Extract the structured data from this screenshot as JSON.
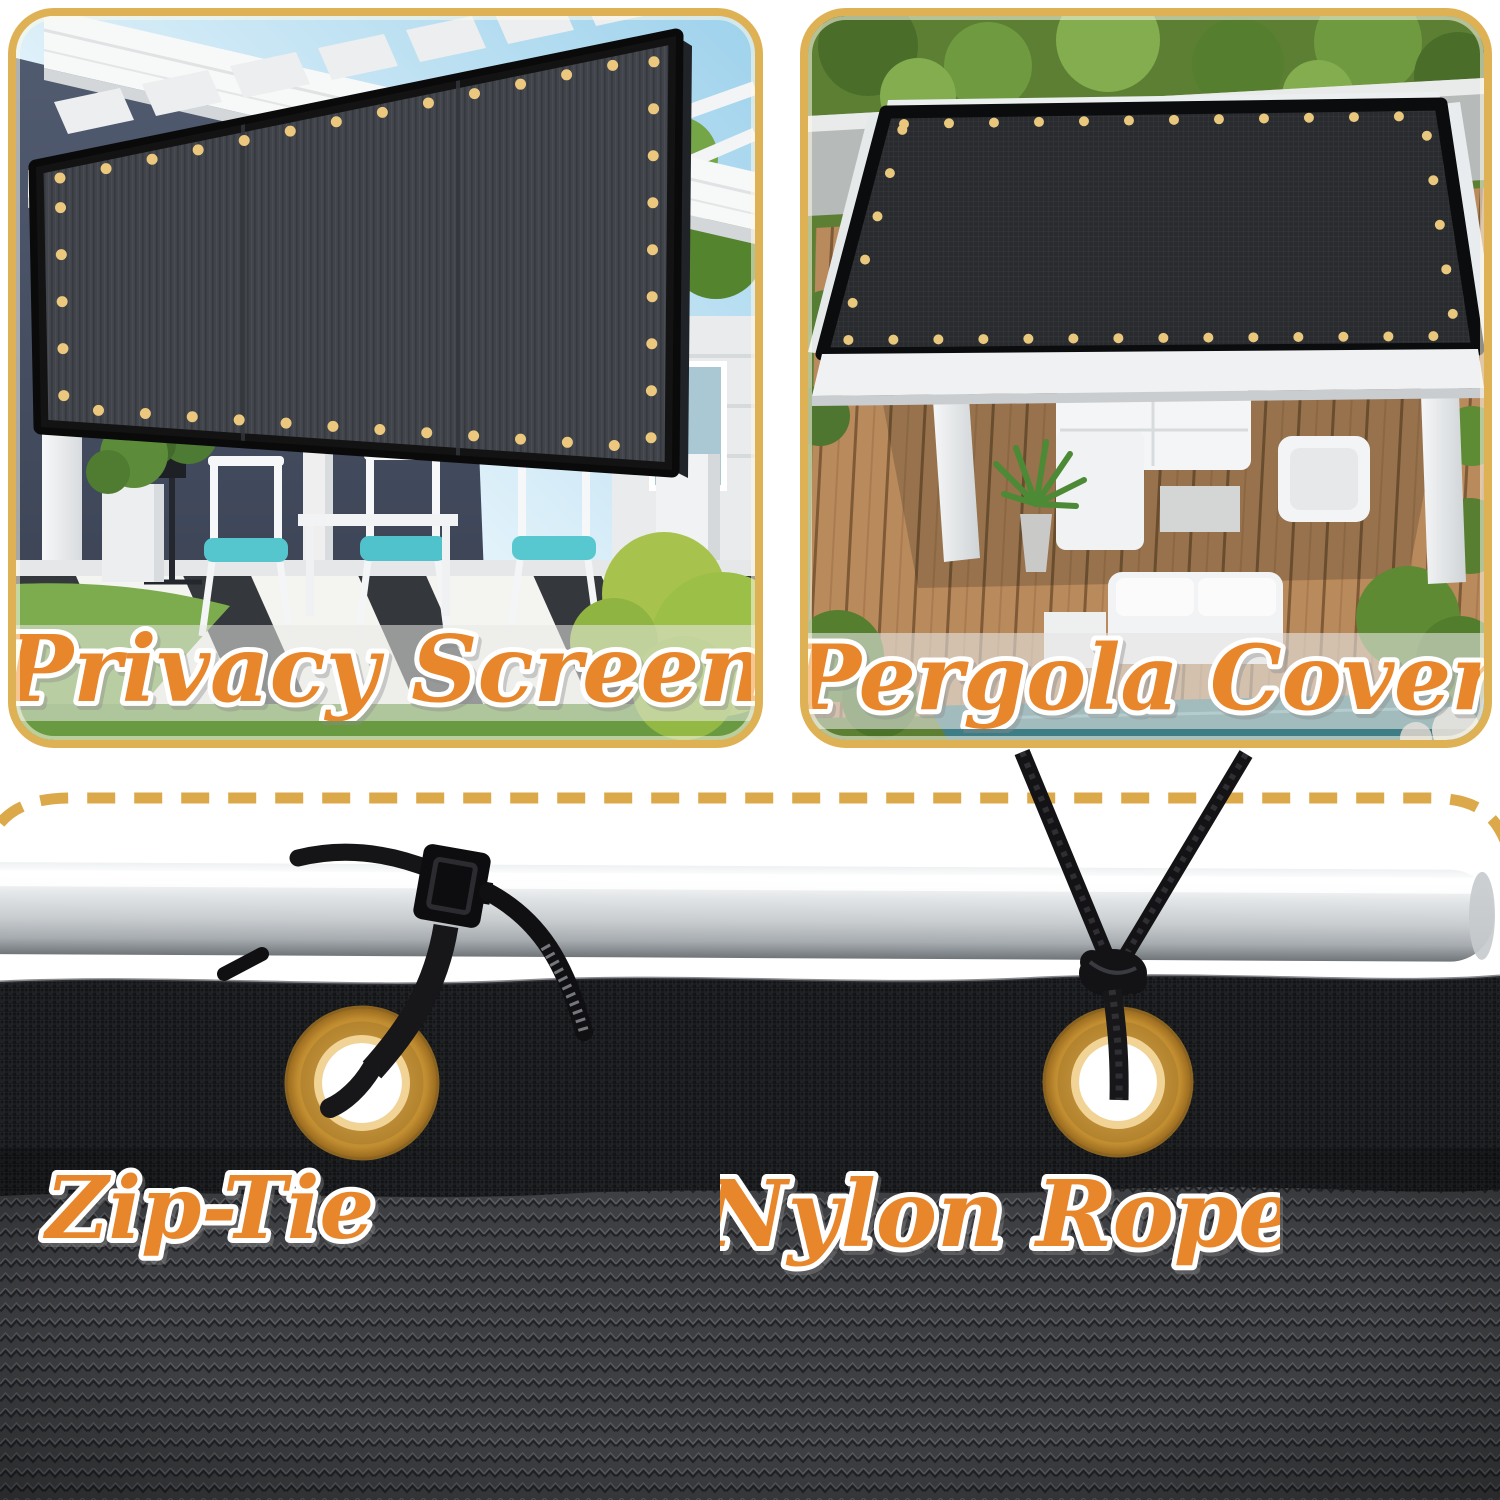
{
  "panels": {
    "privacy": {
      "label": "Privacy Screen"
    },
    "pergola": {
      "label": "Pergola Cover"
    }
  },
  "details": {
    "zip_tie": {
      "label": "Zip-Tie"
    },
    "nylon_rope": {
      "label": "Nylon Rope"
    }
  },
  "colors": {
    "panel_border_gold": "#dfb155",
    "dashed_line_gold": "#dca94a",
    "label_orange": "#e8862b",
    "label_outline_white": "#ffffff",
    "grommet_brass": "#d9a94c",
    "screen_mesh_charcoal": "#383b41",
    "fabric_hem_black": "#131416",
    "knit_fabric_gray": "#3e3f42",
    "rail_silver": "#d8dcdf",
    "cushion_teal": "#55c6ce"
  },
  "icons": {
    "grommet": "brass-grommet-icon",
    "zip_tie": "zip-tie-icon",
    "nylon_rope": "nylon-rope-icon",
    "rail": "aluminum-rail-icon",
    "dashed_outline": "gold-dashed-outline-icon"
  }
}
